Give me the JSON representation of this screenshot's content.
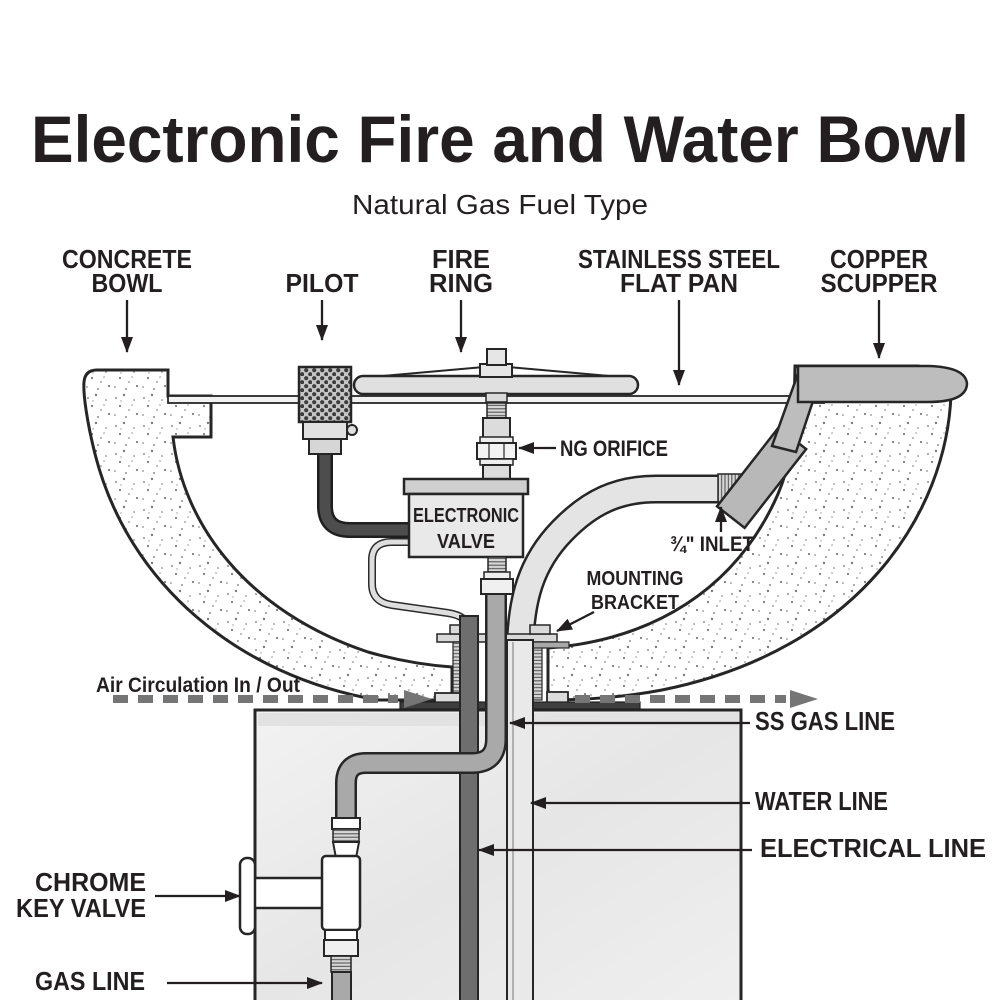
{
  "header": {
    "title": "Electronic Fire and Water Bowl",
    "subtitle": "Natural Gas Fuel Type"
  },
  "callouts": {
    "concrete_bowl": {
      "lines": [
        "CONCRETE",
        "BOWL"
      ]
    },
    "pilot": {
      "lines": [
        "PILOT"
      ]
    },
    "fire_ring": {
      "lines": [
        "FIRE",
        "RING"
      ]
    },
    "stainless_flat_pan": {
      "lines": [
        "STAINLESS STEEL",
        "FLAT PAN"
      ]
    },
    "copper_scupper": {
      "lines": [
        "COPPER",
        "SCUPPER"
      ]
    },
    "ng_orifice": {
      "lines": [
        "NG ORIFICE"
      ]
    },
    "inlet": {
      "lines": [
        "¾\" INLET"
      ]
    },
    "mounting_bracket": {
      "lines": [
        "MOUNTING",
        "BRACKET"
      ]
    },
    "air_circulation": {
      "lines": [
        "Air Circulation In / Out"
      ]
    },
    "ss_gas_line": {
      "lines": [
        "SS GAS LINE"
      ]
    },
    "water_line": {
      "lines": [
        "WATER LINE"
      ]
    },
    "electrical_line": {
      "lines": [
        "ELECTRICAL LINE"
      ]
    },
    "chrome_key_valve": {
      "lines": [
        "CHROME",
        "KEY VALVE"
      ]
    },
    "gas_line": {
      "lines": [
        "GAS LINE"
      ]
    }
  },
  "components": {
    "electronic_valve": {
      "lines": [
        "ELECTRONIC",
        "VALVE"
      ]
    }
  },
  "colors": {
    "ink": "#231f20",
    "outline": "#262626",
    "muted_gray": "#6b6b6b",
    "dash_gray": "#757575",
    "metal_light": "#e4e4e4",
    "metal_mid": "#a9a9a9",
    "metal_dark": "#6e6e6e",
    "scupper_gray": "#bdbdbd",
    "pedestal_fill": "#ececec"
  }
}
